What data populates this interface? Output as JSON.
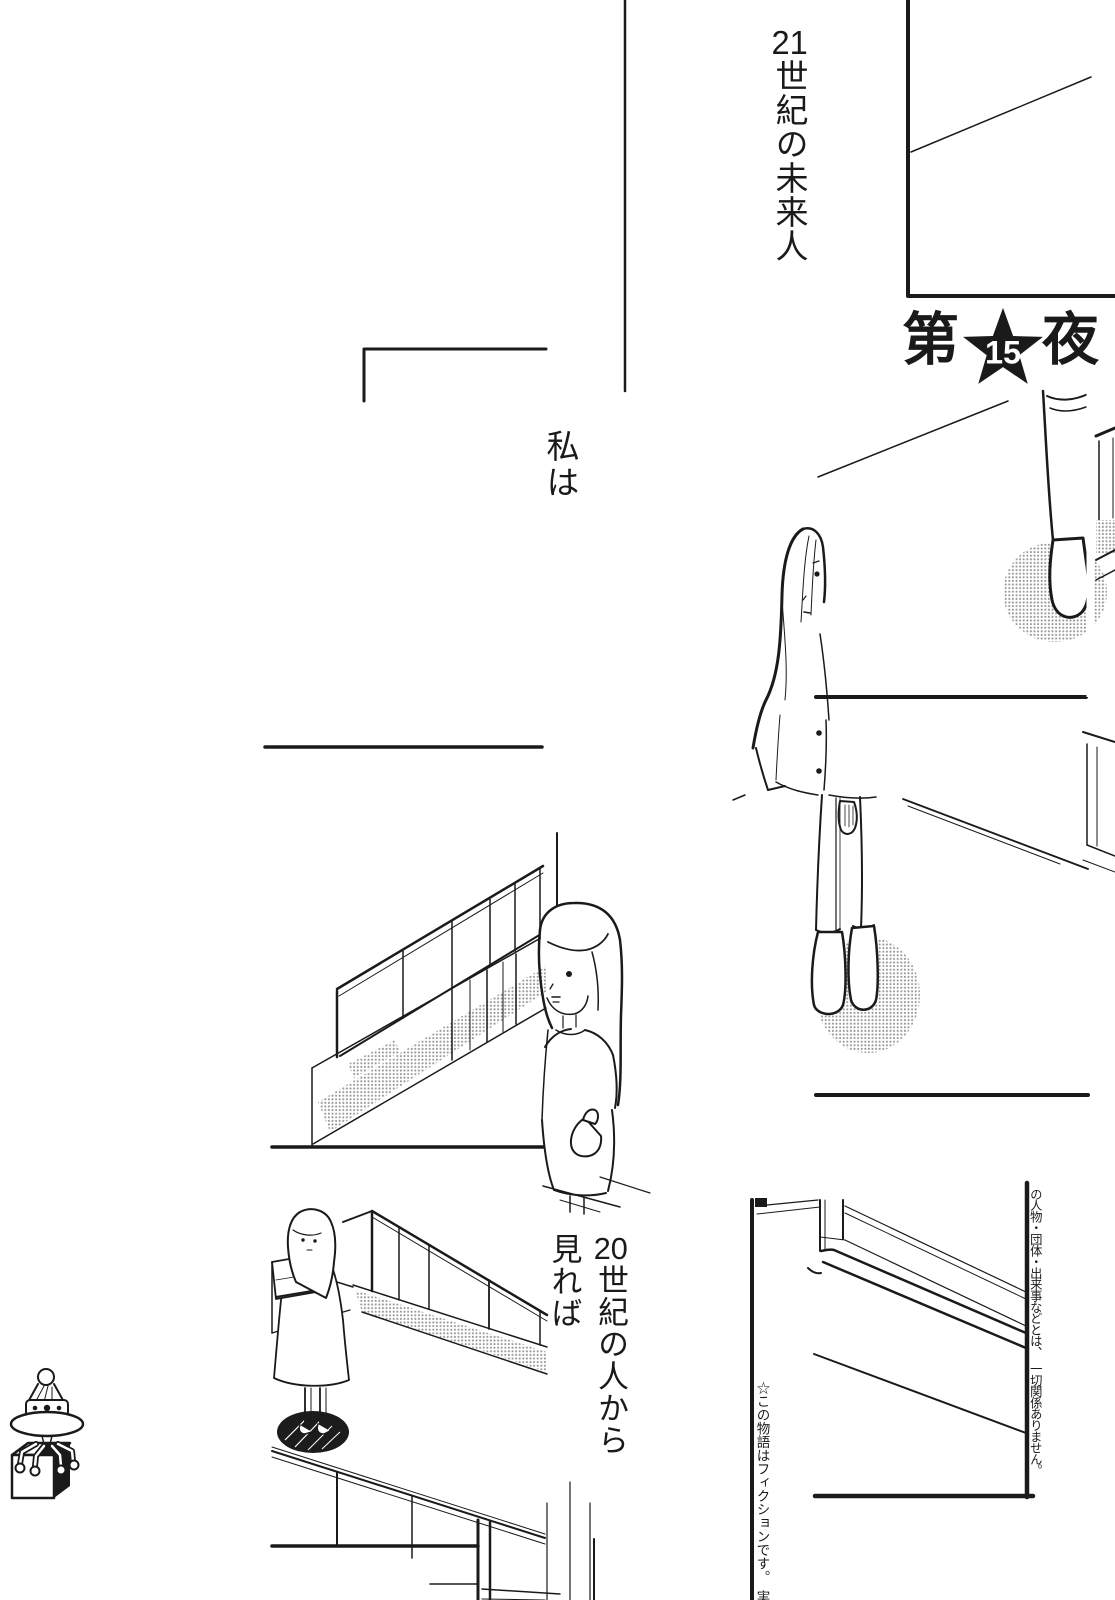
{
  "page": {
    "kind": "manga page",
    "paper_color": "#ffffff",
    "ink_color": "#1a1a1a",
    "halftone_color": "#9a9a9a"
  },
  "captions": {
    "opening": {
      "digits": "21",
      "tail": "世紀の未来人",
      "full": "21世紀の未来人"
    },
    "monologue_i": {
      "text": "私は"
    },
    "monologue_from": {
      "digits": "20",
      "line1_tail": "世紀の人から",
      "line2": "見れば",
      "full": "20世紀の人から見れば"
    }
  },
  "chapter_title": {
    "prefix": "第",
    "number": "15",
    "suffix": "夜",
    "full": "第15夜",
    "badge": "black star with white number"
  },
  "disclaimer": {
    "column_first": "☆この物語はフィクションです。　実在",
    "column_second": "の人物・団体・出来事などとは、　一切関係ありません。",
    "full": "☆この物語はフィクションです。実在の人物・団体・出来事などとは、一切関係ありません。"
  },
  "icons": {
    "chapter_badge": "star-icon",
    "margin_doodle": "ufo-robot-carrying-cube-icon"
  }
}
